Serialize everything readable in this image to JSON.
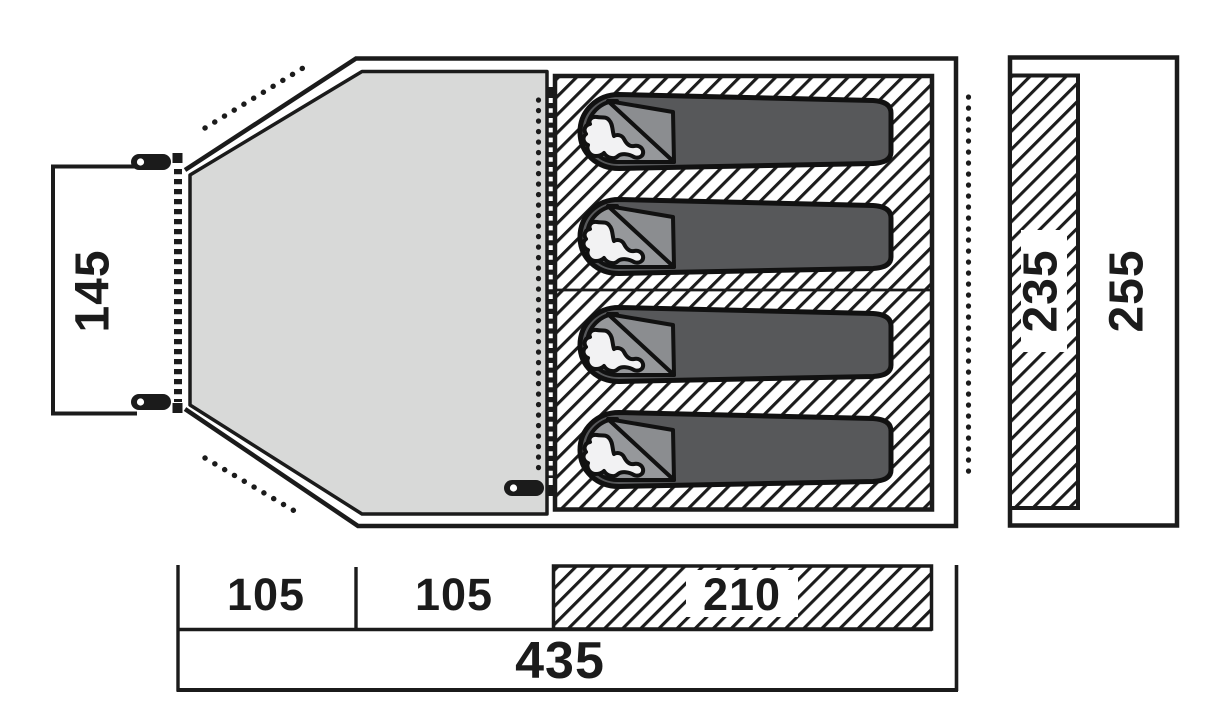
{
  "floorplan": {
    "title": "tent floor plan (top view with side profile)",
    "dimensions": {
      "entrance_width": "145",
      "porch_front_length": "105",
      "porch_rear_length": "105",
      "inner_tent_length": "210",
      "total_length": "435",
      "inner_tent_width": "235",
      "total_width": "255"
    },
    "sleeping_bags": 4,
    "areas": {
      "porch": "canopy / porch area",
      "inner_tent": "sleeping cabin with 4 sleeping bags",
      "side_profile": "width profile bar"
    },
    "icons": {
      "tent_peg": "tent-peg-icon",
      "zipper": "zipper-teeth-line",
      "door_fabric": "dotted-door-line",
      "guyline": "dotted-guyline"
    },
    "colors": {
      "line": "#1b1b1b",
      "porch_fill": "#d8d9d8",
      "sleeping_bag": "#57585a",
      "bag_head": "#96989b",
      "bag_flap": "#8b8d90",
      "silhouette": "#f2f2f3",
      "hatch_bg": "#ffffff"
    }
  }
}
